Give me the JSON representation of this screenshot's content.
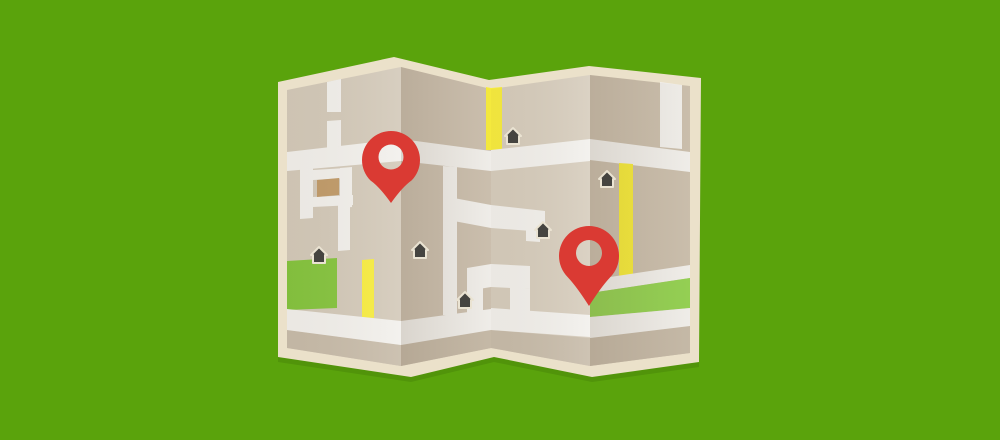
{
  "scene": {
    "description": "Flat illustration of a folded paper street map with two red location pins, six house markers, yellow roads and green parks on a bright green background",
    "width": 1000,
    "height": 440
  },
  "colors": {
    "background_green": "#5aa30c",
    "paper_border": "#ebe1ca",
    "shadow": "rgba(20,40,0,0.12)",
    "panel1_base": "#d3c9b9",
    "panel2_base": "#cdc1b0",
    "panel3_base": "#d6ccbc",
    "panel4_base": "#ccc0ae",
    "road_white": "#f2f0ec",
    "road_yellow": "#f7ec3d",
    "park_green": "#84c43d",
    "band_green": "#95d254",
    "taupe_strip": "#c7bba9",
    "house_dark": "#454440",
    "house_outline": "#eae3d2",
    "building_brown": "#c09a68",
    "pin_red": "#da3a33"
  },
  "shadow": {
    "offset_y": 5
  },
  "border": {
    "points": [
      [
        278,
        82
      ],
      [
        394,
        57
      ],
      [
        489,
        80
      ],
      [
        589,
        66
      ],
      [
        701,
        78
      ],
      [
        699,
        362
      ],
      [
        592,
        377
      ],
      [
        494,
        357
      ],
      [
        411,
        377
      ],
      [
        278,
        357
      ]
    ]
  },
  "panels": [
    {
      "name": "panel-1",
      "base": {
        "fill": "panel1_base",
        "points": [
          [
            287,
            90
          ],
          [
            401,
            67
          ],
          [
            401,
            366
          ],
          [
            287,
            348
          ]
        ]
      },
      "overlay": {
        "from": "rgba(100,85,60,0.05)",
        "to": "rgba(255,255,255,0.10)"
      },
      "shapes": [
        {
          "name": "taupe-strip",
          "fill": "taupe_strip",
          "points": [
            [
              287,
              330
            ],
            [
              401,
              345
            ],
            [
              401,
              366
            ],
            [
              287,
              348
            ]
          ]
        },
        {
          "name": "park-rect",
          "fill": "park_green",
          "points": [
            [
              287,
              261
            ],
            [
              337,
              258
            ],
            [
              337,
              308
            ],
            [
              287,
              310
            ]
          ]
        },
        {
          "name": "yellow-road",
          "fill": "road_yellow",
          "points": [
            [
              362,
              260
            ],
            [
              374,
              259
            ],
            [
              374,
              318
            ],
            [
              362,
              317
            ]
          ]
        },
        {
          "name": "main-road",
          "fill": "road_white",
          "points": [
            [
              287,
              152
            ],
            [
              401,
              139
            ],
            [
              401,
              161
            ],
            [
              287,
              171
            ]
          ]
        },
        {
          "name": "top-vertical-road-a",
          "fill": "road_white",
          "points": [
            [
              327,
              82
            ],
            [
              341,
              79
            ],
            [
              341,
              112
            ],
            [
              327,
              112
            ]
          ]
        },
        {
          "name": "top-vertical-road-b",
          "fill": "road_white",
          "points": [
            [
              327,
              121
            ],
            [
              341,
              120
            ],
            [
              341,
              146
            ],
            [
              327,
              148
            ]
          ]
        },
        {
          "name": "mid-vertical-road",
          "fill": "road_white",
          "points": [
            [
              300,
              168
            ],
            [
              313,
              167
            ],
            [
              313,
              218
            ],
            [
              300,
              219
            ]
          ]
        },
        {
          "name": "block-top-road",
          "fill": "road_white",
          "points": [
            [
              313,
              170
            ],
            [
              346,
              168
            ],
            [
              346,
              178
            ],
            [
              313,
              180
            ]
          ]
        },
        {
          "name": "block-right-road",
          "fill": "road_white",
          "points": [
            [
              340,
              168
            ],
            [
              352,
              167
            ],
            [
              352,
              207
            ],
            [
              340,
              208
            ]
          ]
        },
        {
          "name": "block-bottom-road",
          "fill": "road_white",
          "points": [
            [
              313,
              197
            ],
            [
              353,
              195
            ],
            [
              353,
              205
            ],
            [
              313,
              207
            ]
          ]
        },
        {
          "name": "lower-vertical-road",
          "fill": "road_white",
          "points": [
            [
              338,
              205
            ],
            [
              350,
              204
            ],
            [
              350,
              250
            ],
            [
              338,
              251
            ]
          ]
        },
        {
          "name": "bottom-road",
          "fill": "road_white",
          "points": [
            [
              287,
              309
            ],
            [
              401,
              321
            ],
            [
              401,
              345
            ],
            [
              287,
              330
            ]
          ]
        },
        {
          "name": "building-rect",
          "fill": "building_brown",
          "points": [
            [
              317,
              180
            ],
            [
              339,
              178
            ],
            [
              339,
              195
            ],
            [
              317,
              197
            ]
          ]
        }
      ]
    },
    {
      "name": "panel-2",
      "base": {
        "fill": "panel2_base",
        "points": [
          [
            401,
            67
          ],
          [
            491,
            89
          ],
          [
            491,
            348
          ],
          [
            401,
            366
          ]
        ]
      },
      "overlay": {
        "from": "rgba(90,70,45,0.16)",
        "to": "rgba(90,70,45,0.02)"
      },
      "shapes": [
        {
          "name": "taupe-strip",
          "fill": "taupe_strip",
          "points": [
            [
              401,
              345
            ],
            [
              491,
              330
            ],
            [
              491,
              348
            ],
            [
              401,
              366
            ]
          ]
        },
        {
          "name": "main-road",
          "fill": "road_white",
          "points": [
            [
              401,
              139
            ],
            [
              491,
              151
            ],
            [
              491,
              171
            ],
            [
              401,
              161
            ]
          ]
        },
        {
          "name": "mid-vertical-road",
          "fill": "road_white",
          "points": [
            [
              443,
              166
            ],
            [
              457,
              167
            ],
            [
              457,
              316
            ],
            [
              443,
              315
            ]
          ]
        },
        {
          "name": "branch-road",
          "fill": "road_white",
          "points": [
            [
              443,
              196
            ],
            [
              491,
              205
            ],
            [
              491,
              228
            ],
            [
              443,
              219
            ]
          ]
        },
        {
          "name": "valley-stub-h",
          "fill": "road_white",
          "points": [
            [
              467,
              268
            ],
            [
              491,
              264
            ],
            [
              491,
              287
            ],
            [
              467,
              291
            ]
          ]
        },
        {
          "name": "valley-stub-v",
          "fill": "road_white",
          "points": [
            [
              467,
              290
            ],
            [
              483,
              288
            ],
            [
              483,
              316
            ],
            [
              467,
              318
            ]
          ]
        },
        {
          "name": "bottom-road",
          "fill": "road_white",
          "points": [
            [
              401,
              321
            ],
            [
              491,
              309
            ],
            [
              491,
              330
            ],
            [
              401,
              345
            ]
          ]
        },
        {
          "name": "yellow-sliver",
          "fill": "road_yellow",
          "points": [
            [
              486,
              87
            ],
            [
              491,
              88
            ],
            [
              491,
              150
            ],
            [
              486,
              150
            ]
          ]
        }
      ]
    },
    {
      "name": "panel-3",
      "base": {
        "fill": "panel3_base",
        "points": [
          [
            491,
            89
          ],
          [
            590,
            75
          ],
          [
            590,
            366
          ],
          [
            491,
            348
          ]
        ]
      },
      "overlay": {
        "from": "rgba(100,85,60,0.05)",
        "to": "rgba(255,255,255,0.12)"
      },
      "shapes": [
        {
          "name": "taupe-strip",
          "fill": "taupe_strip",
          "points": [
            [
              491,
              330
            ],
            [
              590,
              338
            ],
            [
              590,
              366
            ],
            [
              491,
              348
            ]
          ]
        },
        {
          "name": "yellow-road",
          "fill": "road_yellow",
          "points": [
            [
              491,
              88
            ],
            [
              502,
              87
            ],
            [
              502,
              150
            ],
            [
              491,
              150
            ]
          ]
        },
        {
          "name": "main-road",
          "fill": "road_white",
          "points": [
            [
              491,
              150
            ],
            [
              590,
              139
            ],
            [
              590,
              161
            ],
            [
              491,
              171
            ]
          ]
        },
        {
          "name": "branch-road",
          "fill": "road_white",
          "points": [
            [
              491,
              205
            ],
            [
              545,
              211
            ],
            [
              545,
              232
            ],
            [
              491,
              228
            ]
          ]
        },
        {
          "name": "branch-stub",
          "fill": "road_white",
          "points": [
            [
              526,
              228
            ],
            [
              540,
              229
            ],
            [
              540,
              242
            ],
            [
              526,
              241
            ]
          ]
        },
        {
          "name": "zigzag-top-road",
          "fill": "road_white",
          "points": [
            [
              491,
              264
            ],
            [
              530,
              266
            ],
            [
              530,
              289
            ],
            [
              491,
              287
            ]
          ]
        },
        {
          "name": "zigzag-column",
          "fill": "road_white",
          "points": [
            [
              510,
              287
            ],
            [
              530,
              289
            ],
            [
              530,
              312
            ],
            [
              510,
              310
            ]
          ]
        },
        {
          "name": "bottom-road",
          "fill": "road_white",
          "points": [
            [
              491,
              308
            ],
            [
              590,
              315
            ],
            [
              590,
              337
            ],
            [
              491,
              330
            ]
          ]
        }
      ]
    },
    {
      "name": "panel-4",
      "base": {
        "fill": "panel4_base",
        "points": [
          [
            590,
            75
          ],
          [
            690,
            86
          ],
          [
            690,
            353
          ],
          [
            590,
            366
          ]
        ]
      },
      "overlay": {
        "from": "rgba(90,70,45,0.15)",
        "to": "rgba(90,70,45,0.02)"
      },
      "shapes": [
        {
          "name": "taupe-strip",
          "fill": "taupe_strip",
          "points": [
            [
              590,
              338
            ],
            [
              690,
              326
            ],
            [
              690,
              353
            ],
            [
              590,
              366
            ]
          ]
        },
        {
          "name": "main-road",
          "fill": "road_white",
          "points": [
            [
              590,
              139
            ],
            [
              690,
              152
            ],
            [
              690,
              172
            ],
            [
              590,
              160
            ]
          ]
        },
        {
          "name": "top-vertical-road",
          "fill": "road_white",
          "points": [
            [
              660,
              82
            ],
            [
              682,
              85
            ],
            [
              682,
              149
            ],
            [
              660,
              147
            ]
          ]
        },
        {
          "name": "yellow-road",
          "fill": "road_yellow",
          "points": [
            [
              619,
              163
            ],
            [
              633,
              164
            ],
            [
              633,
              276
            ],
            [
              619,
              278
            ]
          ]
        },
        {
          "name": "band-above-green",
          "fill": "road_white",
          "points": [
            [
              590,
              280
            ],
            [
              690,
              265
            ],
            [
              690,
              278
            ],
            [
              590,
              293
            ]
          ]
        },
        {
          "name": "green-band",
          "fill": "band_green",
          "points": [
            [
              590,
              293
            ],
            [
              690,
              278
            ],
            [
              690,
              308
            ],
            [
              590,
              317
            ]
          ]
        },
        {
          "name": "band-below-green",
          "fill": "road_white",
          "points": [
            [
              590,
              317
            ],
            [
              690,
              308
            ],
            [
              690,
              326
            ],
            [
              590,
              338
            ]
          ]
        }
      ]
    }
  ],
  "houses": {
    "fill": "house_dark",
    "outline": "house_outline",
    "positions": [
      {
        "x": 513,
        "y": 136
      },
      {
        "x": 607,
        "y": 179
      },
      {
        "x": 543,
        "y": 230
      },
      {
        "x": 319,
        "y": 255
      },
      {
        "x": 420,
        "y": 250
      },
      {
        "x": 465,
        "y": 300
      }
    ]
  },
  "pins": [
    {
      "x": 391,
      "y": 160,
      "r": 29,
      "tail": 43,
      "hole_r": 12.5,
      "hole_dy": -3
    },
    {
      "x": 589,
      "y": 256,
      "r": 30,
      "tail": 50,
      "hole_r": 13,
      "hole_dy": -3
    }
  ]
}
